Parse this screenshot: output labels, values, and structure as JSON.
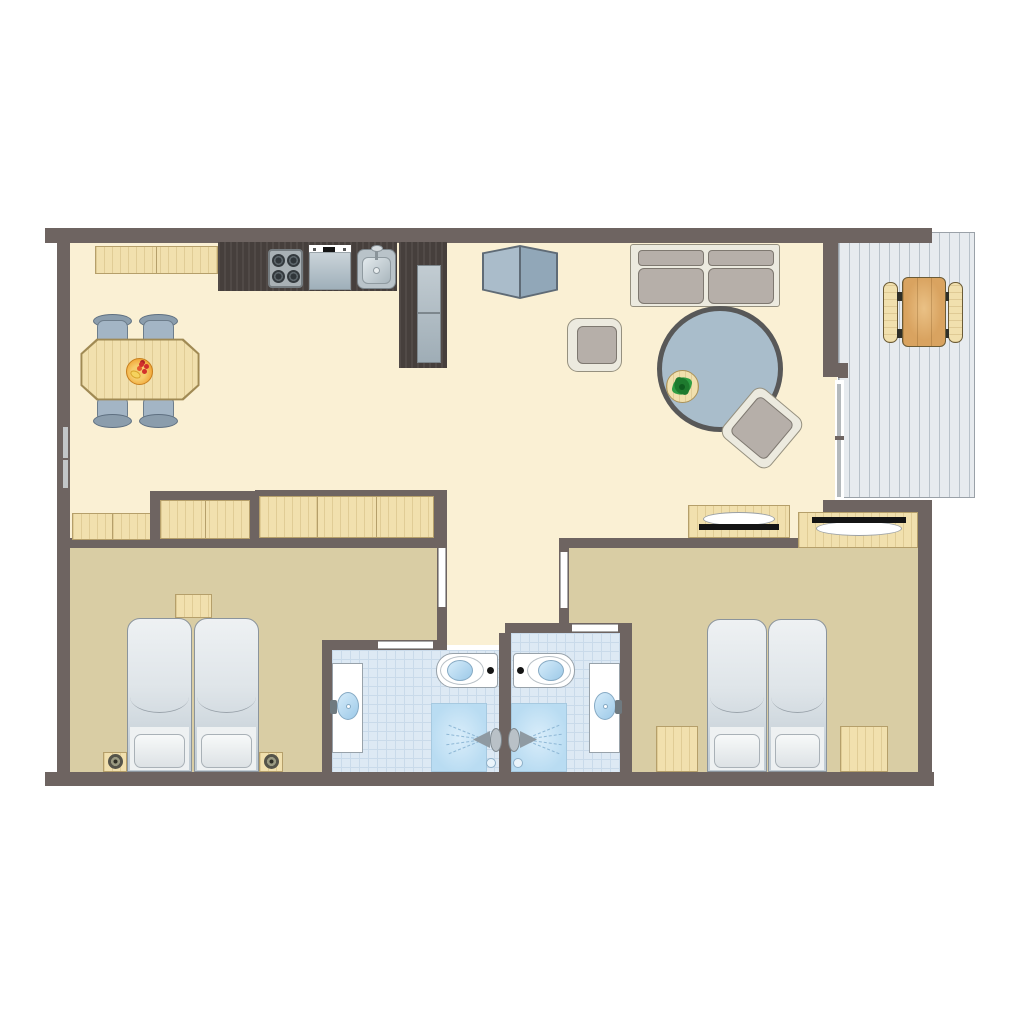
{
  "title": "holiday-home-floor-plan",
  "palette": {
    "wall": "#6e6461",
    "floor_main": "#faf0d4",
    "floor_bedroom": "#d9cda4",
    "tile": "#dde9f4",
    "tile_grid": "#c9daea",
    "deck": "#e7ebef",
    "deck_line": "#b9c2ca",
    "wood_light": "#f1e0ae",
    "wood_border": "#b59f6a",
    "wood_mid": "#d9a360",
    "wood_dark": "#463f3c",
    "appliance": "#b7c1c8",
    "appliance_border": "#7d878d",
    "fabric": "#b6afa9",
    "fabric_border": "#7e7870",
    "frame": "#eceadf",
    "frame_border": "#95907f",
    "chair_blue": "#a3b5c5",
    "chair_blue_border": "#6d7d8b",
    "chair_bar": "#8b9dac",
    "rug": "#a9bdcb",
    "rug_border": "#585858",
    "bed_top": "#eef1f3",
    "bed_mid": "#dfe5e9",
    "bed_low": "#c2cdd5",
    "bed_border": "#8b949c",
    "glass": "#b4b9bc",
    "window": "#c2c6c8",
    "water_border": "#86aac4",
    "shower_hi": "#d9edfa",
    "shower_lo": "#b9dcf2",
    "spray": "#8fb8d6",
    "plant": "#2f9e44",
    "plant_dark": "#1e7a2e",
    "fruit": "#f2a93b",
    "fruit_red": "#d2302c",
    "black": "#141414",
    "open_line": "#a9a9a9"
  },
  "rooms": [
    {
      "id": "living-dining-kitchen",
      "floor": "cream",
      "furniture": [
        "kitchen-counter",
        "stove-4-burners",
        "dishwasher",
        "kitchen-sink",
        "tall-cabinet-fridge",
        "dining-table",
        "dining-chair x4",
        "fruit-bowl",
        "cabinet-cube",
        "sofa-2-seat",
        "armchair",
        "round-rug",
        "side-table",
        "potted-plant",
        "lounge-chair-angled",
        "sideboard",
        "hall-wardrobe"
      ]
    },
    {
      "id": "hallway",
      "floor": "cream",
      "furniture": []
    },
    {
      "id": "bedroom-left",
      "floor": "tan",
      "furniture": [
        "single-bed x2",
        "bedside-table-with-knob x2",
        "foot-shelf",
        "built-in-closet",
        "built-in-wardrobe-3-door"
      ]
    },
    {
      "id": "bedroom-right",
      "floor": "tan",
      "furniture": [
        "single-bed x2",
        "bedside-table x2",
        "wardrobe-with-rail"
      ]
    },
    {
      "id": "bathroom-left",
      "floor": "tile",
      "furniture": [
        "washbasin",
        "toilet",
        "shower-with-spray",
        "floor-drain"
      ]
    },
    {
      "id": "bathroom-right",
      "floor": "tile",
      "furniture": [
        "washbasin",
        "toilet",
        "shower-with-spray",
        "floor-drain"
      ]
    },
    {
      "id": "terrace",
      "floor": "deck-planks",
      "furniture": [
        "picnic-table",
        "bench x2"
      ]
    }
  ],
  "openings": [
    "window-left-wall",
    "sliding-door-terrace",
    "door-bedroom-left",
    "door-bedroom-right",
    "door-bathroom-left",
    "door-bathroom-right"
  ],
  "counts": {
    "bedrooms": 2,
    "bathrooms": 2,
    "beds": 4,
    "dining_chairs": 4,
    "benches": 2
  }
}
